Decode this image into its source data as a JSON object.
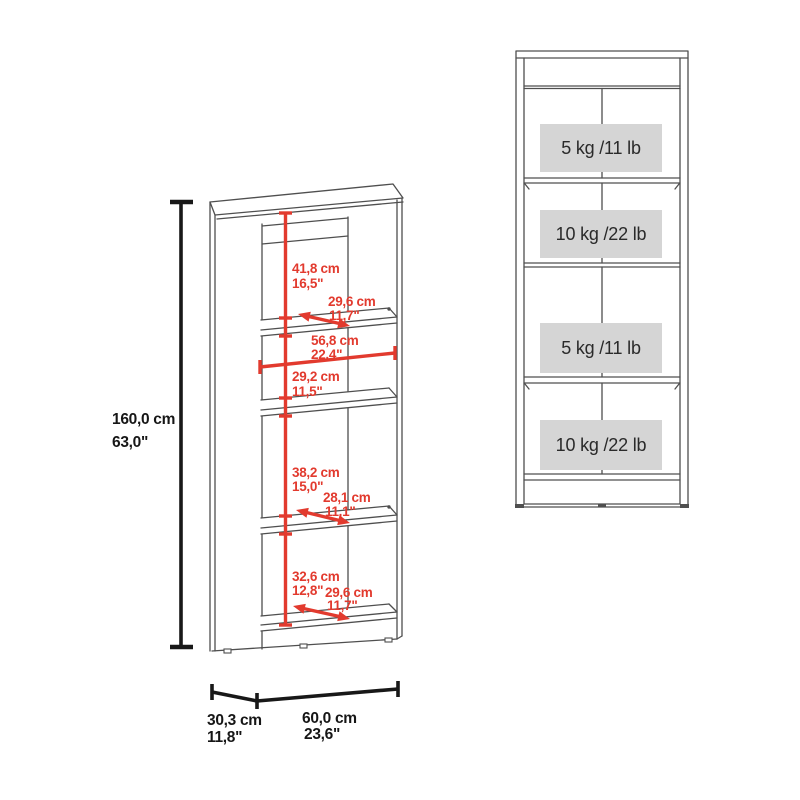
{
  "left_view": {
    "overall_height": {
      "cm": "160,0 cm",
      "in": "63,0\""
    },
    "sections": [
      {
        "cm": "41,8 cm",
        "in": "16,5\""
      },
      {
        "cm": "29,2 cm",
        "in": "11,5\""
      },
      {
        "cm": "38,2 cm",
        "in": "15,0\""
      },
      {
        "cm": "32,6 cm",
        "in": "12,8\""
      }
    ],
    "shelf_depths": [
      {
        "cm": "29,6 cm",
        "in": "11,7\""
      },
      {
        "cm": "28,1 cm",
        "in": "11,1\""
      },
      {
        "cm": "29,6 cm",
        "in": "11,7\""
      }
    ],
    "interior_width": {
      "cm": "56,8 cm",
      "in": "22,4\""
    },
    "base_depth": {
      "cm": "30,3 cm",
      "in": "11,8\""
    },
    "base_width": {
      "cm": "60,0 cm",
      "in": "23,6\""
    }
  },
  "right_view": {
    "shelf_capacities": [
      {
        "label": "5 kg /11 lb"
      },
      {
        "label": "10 kg /22 lb"
      },
      {
        "label": "5 kg /11 lb"
      },
      {
        "label": "10 kg /22 lb"
      }
    ]
  },
  "colors": {
    "dimension_red": "#e23a2e",
    "outline_gray": "#4f4f4f",
    "dimension_black": "#181818",
    "capacity_box_fill": "#d5d5d5"
  }
}
